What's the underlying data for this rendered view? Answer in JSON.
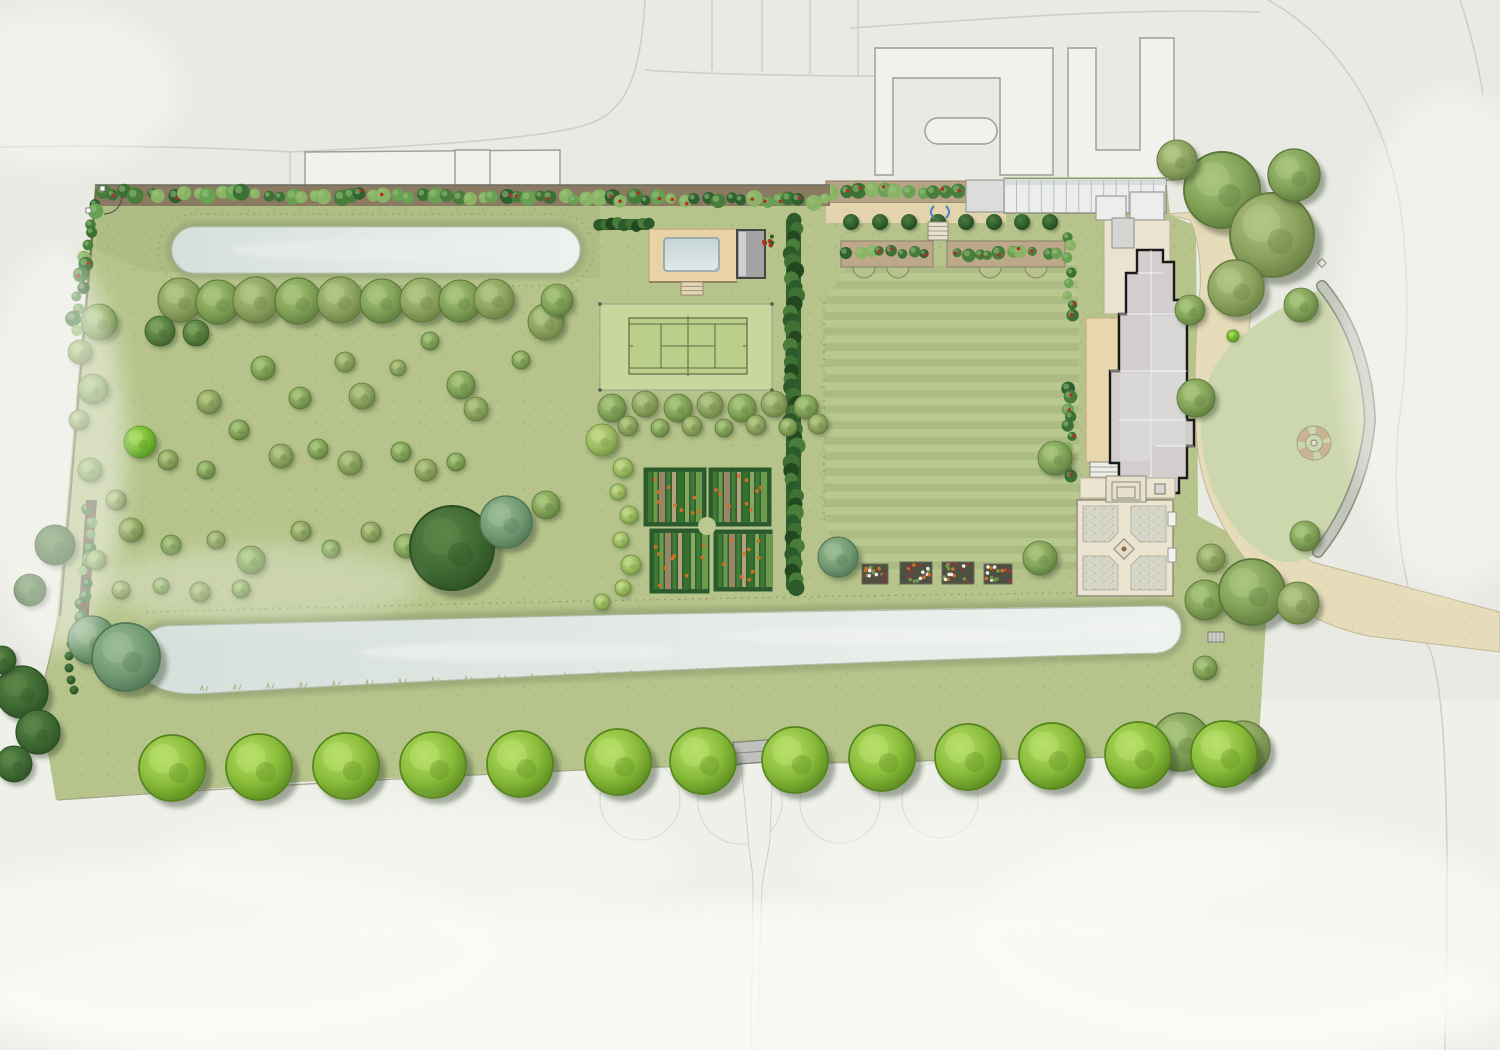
{
  "palette": {
    "bg": "#e9eae3",
    "bg_lower": "#eef0e9",
    "road_line": "#cdd0c6",
    "neighbor_stroke": "#9b9c96",
    "garden_green": "#b6c48b",
    "meadow_shade": "rgba(75,95,45,0.07)",
    "teardrop_lawn": "#cdd7ad",
    "drive_tan": "#e7dcba",
    "forecourt_cream": "#eae3d0",
    "water_light": "#e6ebe7",
    "water_mid": "#d5dfdb",
    "bank_olive": "#9aa877",
    "court_surround": "#c9d69c",
    "court_line": "#6f7e53",
    "deck_tan": "#e8d2a6",
    "pool_house_gray": "#a3a3a3",
    "house_roof": "#d1cecd",
    "house_outline": "#1a1a1a",
    "hedge_dark": "#31602e",
    "soil_brown": "#b5a385",
    "bed_border_green": "#2a5a2c",
    "orange_crop": "#d07028",
    "red_flower": "#b03028",
    "wall_gray": "#c2c6ba",
    "wall_edge": "#83877c",
    "gravel": "#d5d6c8",
    "path_cream": "#ebe4d1",
    "glyph_blue": "#4a84bb",
    "avenue_green": "#8abd3a"
  },
  "trees": {
    "tones": [
      {
        "hi": "#b8e06a",
        "body": "#8abd3a",
        "rim": "#55841c"
      },
      {
        "hi": "#c2d98a",
        "body": "#9cba62",
        "rim": "#6f8c3c"
      },
      {
        "hi": "#a9c77d",
        "body": "#82a258",
        "rim": "#5a773a"
      },
      {
        "hi": "#b4c785",
        "body": "#8ca25f",
        "rim": "#647c40"
      },
      {
        "hi": "#7fa35f",
        "body": "#567f3f",
        "rim": "#3a5c2a"
      },
      {
        "hi": "#9dbd96",
        "body": "#739c74",
        "rim": "#4e7252"
      },
      {
        "hi": "#5d8549",
        "body": "#406b34",
        "rim": "#2b4e22"
      },
      {
        "hi": "#4d7c42",
        "body": "#31602e",
        "rim": "#1e441c"
      },
      {
        "hi": "#a5dc5e",
        "body": "#74b931",
        "rim": "#4f8c1e"
      }
    ],
    "avenue": [
      [
        172,
        768
      ],
      [
        259,
        767
      ],
      [
        346,
        766
      ],
      [
        433,
        765
      ],
      [
        520,
        764
      ],
      [
        618,
        762
      ],
      [
        703,
        761
      ],
      [
        795,
        760
      ],
      [
        882,
        758
      ],
      [
        968,
        757
      ],
      [
        1052,
        756
      ],
      [
        1138,
        755
      ],
      [
        1224,
        754
      ]
    ],
    "avenue_r": 33,
    "meadow": [
      [
        180,
        300,
        22,
        3
      ],
      [
        218,
        302,
        22,
        2
      ],
      [
        256,
        300,
        23,
        3
      ],
      [
        298,
        301,
        23,
        2
      ],
      [
        340,
        300,
        23,
        3
      ],
      [
        382,
        301,
        22,
        2
      ],
      [
        422,
        300,
        22,
        3
      ],
      [
        460,
        301,
        21,
        2
      ],
      [
        494,
        299,
        20,
        3
      ],
      [
        160,
        331,
        15,
        4
      ],
      [
        196,
        333,
        13,
        4
      ],
      [
        99,
        322,
        18,
        2
      ],
      [
        80,
        352,
        12,
        3
      ],
      [
        93,
        389,
        15,
        2
      ],
      [
        79,
        420,
        10,
        3
      ],
      [
        140,
        442,
        16,
        8
      ],
      [
        90,
        470,
        12,
        2
      ],
      [
        116,
        500,
        10,
        3
      ],
      [
        96,
        560,
        10,
        2
      ],
      [
        121,
        590,
        9,
        3
      ],
      [
        161,
        586,
        8,
        2
      ],
      [
        200,
        592,
        10,
        3
      ],
      [
        241,
        589,
        9,
        2
      ],
      [
        263,
        368,
        12,
        2
      ],
      [
        345,
        362,
        10,
        3
      ],
      [
        430,
        341,
        9,
        2
      ],
      [
        398,
        368,
        8,
        3
      ],
      [
        300,
        398,
        11,
        2
      ],
      [
        209,
        402,
        12,
        3
      ],
      [
        239,
        430,
        10,
        2
      ],
      [
        362,
        396,
        13,
        3
      ],
      [
        461,
        385,
        14,
        2
      ],
      [
        476,
        409,
        12,
        3
      ],
      [
        521,
        360,
        9,
        2
      ],
      [
        546,
        322,
        18,
        3
      ],
      [
        557,
        300,
        16,
        2
      ],
      [
        168,
        460,
        10,
        3
      ],
      [
        206,
        470,
        9,
        2
      ],
      [
        281,
        456,
        12,
        3
      ],
      [
        318,
        449,
        10,
        2
      ],
      [
        350,
        463,
        12,
        3
      ],
      [
        401,
        452,
        10,
        2
      ],
      [
        426,
        470,
        11,
        3
      ],
      [
        456,
        462,
        9,
        2
      ],
      [
        131,
        530,
        12,
        3
      ],
      [
        171,
        545,
        10,
        2
      ],
      [
        216,
        540,
        9,
        3
      ],
      [
        251,
        560,
        14,
        2
      ],
      [
        301,
        531,
        10,
        3
      ],
      [
        331,
        549,
        9,
        2
      ],
      [
        371,
        532,
        10,
        3
      ],
      [
        406,
        546,
        12,
        2
      ],
      [
        441,
        520,
        10,
        3
      ],
      [
        452,
        548,
        42,
        6
      ],
      [
        506,
        522,
        26,
        5
      ],
      [
        546,
        505,
        14,
        2
      ],
      [
        92,
        640,
        24,
        5
      ],
      [
        126,
        657,
        34,
        5
      ],
      [
        22,
        692,
        26,
        6
      ],
      [
        38,
        732,
        22,
        6
      ],
      [
        14,
        764,
        18,
        6
      ],
      [
        2,
        660,
        14,
        6
      ],
      [
        55,
        545,
        20,
        6
      ],
      [
        30,
        590,
        16,
        6
      ],
      [
        602,
        440,
        16,
        1
      ],
      [
        623,
        468,
        10,
        1
      ],
      [
        618,
        492,
        8,
        1
      ],
      [
        629,
        515,
        9,
        1
      ],
      [
        621,
        540,
        8,
        1
      ],
      [
        631,
        565,
        10,
        1
      ],
      [
        623,
        588,
        8,
        1
      ],
      [
        602,
        602,
        8,
        1
      ],
      [
        612,
        408,
        14,
        2
      ],
      [
        645,
        404,
        13,
        3
      ],
      [
        678,
        408,
        14,
        2
      ],
      [
        710,
        405,
        13,
        3
      ],
      [
        742,
        408,
        14,
        2
      ],
      [
        774,
        404,
        13,
        3
      ],
      [
        806,
        407,
        12,
        2
      ],
      [
        628,
        426,
        10,
        3
      ],
      [
        660,
        428,
        9,
        2
      ],
      [
        692,
        426,
        10,
        3
      ],
      [
        724,
        428,
        9,
        2
      ],
      [
        756,
        425,
        10,
        3
      ],
      [
        788,
        427,
        9,
        2
      ],
      [
        818,
        424,
        10,
        3
      ],
      [
        838,
        557,
        20,
        5
      ],
      [
        1040,
        558,
        17,
        2
      ],
      [
        1055,
        458,
        17,
        2
      ],
      [
        1205,
        600,
        20,
        2
      ],
      [
        1252,
        592,
        33,
        2
      ],
      [
        1298,
        603,
        21,
        3
      ],
      [
        1211,
        558,
        14,
        3
      ],
      [
        1205,
        668,
        12,
        2
      ],
      [
        1181,
        742,
        29,
        2
      ],
      [
        1243,
        748,
        27,
        3
      ],
      [
        1190,
        310,
        15,
        2
      ],
      [
        1196,
        398,
        19,
        2
      ],
      [
        1228,
        300,
        9,
        8
      ],
      [
        1233,
        336,
        6,
        8
      ],
      [
        1305,
        536,
        15,
        2
      ],
      [
        1222,
        190,
        38,
        2
      ],
      [
        1272,
        235,
        42,
        3
      ],
      [
        1294,
        175,
        26,
        2
      ],
      [
        1236,
        288,
        28,
        3
      ],
      [
        1301,
        305,
        17,
        2
      ],
      [
        1177,
        160,
        20,
        3
      ]
    ]
  },
  "map": {
    "canvas": [
      1500,
      1050
    ],
    "roads": [
      "M0,147 C150,144 260,150 290,152 L290,186",
      "M290,152 C420,146 520,140 575,128 C620,118 640,90 645,0",
      "M712,0 L712,70",
      "M762,0 L762,72",
      "M810,0 L810,74",
      "M858,0 L858,76",
      "M645,70 C700,74 800,76 875,76",
      "M850,28 C1000,18 1120,8 1260,12",
      "M1268,0 C1340,40 1390,120 1402,220 C1410,290 1408,360 1398,430",
      "M1398,430 C1392,520 1402,590 1430,650 C1446,692 1450,820 1445,1050",
      "M1460,0 C1470,30 1478,62 1483,95"
    ],
    "neighbors": [
      {
        "d": "M875,48 L1053,48 L1053,175 L1000,175 L1000,78 L893,78 L893,175 L875,175 Z"
      },
      {
        "d": "M938,118 h46 a13,13 0 0 1 0,26 h-46 a13,13 0 0 1 0,-26 Z"
      },
      {
        "d": "M1068,48 L1096,48 L1096,150 L1140,150 L1140,38 L1174,38 L1174,180 L1068,180 Z"
      },
      {
        "d": "M305,152 L560,150 L560,186 L305,186 Z"
      },
      {
        "d": "M455,150 L490,150 L490,186 L455,186 Z"
      }
    ],
    "faint_circles": [
      [
        640,
        800,
        40
      ],
      [
        740,
        802,
        42
      ],
      [
        840,
        803,
        40
      ],
      [
        940,
        800,
        38
      ]
    ],
    "garden": {
      "d": "M95,184 L828,196 L828,181 L1004,181 L1004,177 L1166,177 L1170,215 L1196,226 L1198,516 L1258,548 L1308,562 L1282,588 L1266,622 L1258,756 L1100,758 L660,767 L300,782 L56,800 L40,706 L57,616 Z",
      "top_shade": "M96,186 L600,196 L600,278 L150,272 L96,250 Z"
    },
    "teardrop": "M1324,288 C1292,300 1246,326 1222,356 C1200,384 1196,428 1206,468 C1216,508 1240,540 1266,556 C1286,566 1306,562 1318,552 C1344,520 1366,472 1370,420 C1368,372 1350,322 1324,288 Z",
    "drive": "M1166,214 L1254,208 C1262,252 1252,300 1246,352 C1240,404 1246,470 1270,515 C1282,536 1298,552 1312,562 L1500,612 L1500,652 L1368,636 C1322,626 1288,606 1262,578 C1226,540 1204,498 1198,452 C1192,400 1196,330 1200,290 C1202,258 1196,232 1190,220 Z",
    "forecourt": [
      1104,
      220,
      66,
      94
    ],
    "wall": "M1322,286 C1352,322 1368,370 1370,420 C1366,472 1344,520 1318,552",
    "circle_feature": [
      1314,
      443
    ],
    "marker": [
      1322,
      263
    ],
    "lawn": {
      "d": "M846,268 L1078,262 L1080,570 L846,574 L824,520 L824,302 Z",
      "dash": [
        824,
        302,
        824,
        520
      ]
    },
    "top_pond": {
      "rect": [
        172,
        227,
        408,
        46,
        23
      ],
      "bank": [
        166,
        221,
        420,
        58,
        29
      ],
      "dash": [
        158,
        214,
        436,
        72,
        36
      ]
    },
    "bottom_pond": {
      "water": "M166,626 C480,617 860,609 1160,606 C1173,606 1181,615 1181,628 C1181,642 1172,651 1158,653 C860,661 500,676 210,693 C186,695 166,693 152,684 C140,676 134,662 138,648 C141,637 151,629 166,626 Z",
      "dots": "M146,612 C500,602 900,594 1172,592"
    },
    "tennis": {
      "surround": [
        600,
        304,
        172,
        86
      ],
      "court": [
        629,
        318,
        118,
        56
      ]
    },
    "pool": {
      "deck": [
        649,
        229,
        88,
        53
      ],
      "water": [
        664,
        238,
        55,
        33
      ],
      "house": [
        737,
        230,
        28,
        48
      ],
      "steps": [
        681,
        282,
        22,
        13
      ],
      "flowers": [
        768,
        240
      ],
      "hedge_left": [
        596,
        219,
        56,
        11
      ]
    },
    "long_hedge": [
      786,
      216,
      15,
      376
    ],
    "kitchen": {
      "beds": [
        [
          645,
          469,
          60,
          56
        ],
        [
          710,
          469,
          60,
          56
        ],
        [
          651,
          530,
          57,
          62
        ],
        [
          715,
          531,
          56,
          59
        ]
      ],
      "circle": [
        707,
        526,
        9
      ],
      "stripe_colors": [
        "#3f7a35",
        "#6b9b4b",
        "#9b8568",
        "#447c39",
        "#b3a07c",
        "#35702f",
        "#86a861"
      ]
    },
    "espalier": {
      "soil": [
        826,
        181,
        178,
        22
      ],
      "path": [
        826,
        203,
        180,
        20
      ],
      "row": [
        834,
        192,
        996,
        192,
        14
      ]
    },
    "greenhouse": {
      "r": [
        1004,
        179,
        162,
        34
      ],
      "ribs": 13
    },
    "shed": [
      966,
      180,
      38,
      32
    ],
    "pleached": {
      "y": 222,
      "xs": [
        851,
        880,
        909,
        938,
        966,
        994,
        1022,
        1050
      ],
      "r": 8
    },
    "terrace_steps": [
      928,
      222,
      20,
      18
    ],
    "glyph": [
      940,
      212
    ],
    "borders": [
      {
        "r": [
          841,
          241,
          92,
          26
        ],
        "scallops": [
          864,
          898
        ]
      },
      {
        "r": [
          947,
          241,
          118,
          26
        ],
        "scallops": [
          990,
          1036
        ]
      }
    ],
    "cutting": [
      [
        862,
        564,
        26,
        20
      ],
      [
        900,
        562,
        32,
        22
      ],
      [
        942,
        562,
        32,
        22
      ],
      [
        984,
        564,
        28,
        20
      ]
    ],
    "house": {
      "outline": "M1137,250 L1163,250 L1163,262 L1174,262 L1174,300 L1181,300 L1181,314 L1187,314 L1187,420 L1194,420 L1194,446 L1187,446 L1187,478 L1179,478 L1179,493 L1156,493 L1156,479 L1119,479 L1119,463 L1110,463 L1110,371 L1119,371 L1119,314 L1126,314 L1126,273 L1137,273 Z",
      "panels": [
        [
          1152,
          316,
          33,
          130
        ],
        [
          1120,
          373,
          30,
          88
        ]
      ],
      "ridges": [
        "M1137,273 L1163,273",
        "M1151,250 L1151,479",
        "M1110,371 L1187,371",
        "M1119,314 L1181,314",
        "M1156,446 L1194,446",
        "M1119,420 L1187,420"
      ],
      "terrace": [
        1086,
        318,
        32,
        144
      ],
      "steps": [
        1090,
        462,
        28,
        30
      ],
      "north": [
        [
          1096,
          196,
          30,
          24
        ],
        [
          1130,
          192,
          34,
          28
        ],
        [
          1112,
          218,
          22,
          30
        ]
      ]
    },
    "west_border": [
      [
        1070,
        236,
        1070,
        316
      ],
      [
        1070,
        388,
        1070,
        478
      ]
    ],
    "walled": {
      "base": [
        1077,
        500,
        96,
        96
      ],
      "quads": [
        "M1083,506 L1118,506 L1118,533 L1109,542 L1083,542 Z",
        "M1131,506 L1166,506 L1166,542 L1140,542 L1131,533 Z",
        "M1083,556 L1109,556 L1118,565 L1118,590 L1083,590 Z",
        "M1140,556 L1166,556 L1166,590 L1131,590 L1131,565 Z"
      ],
      "diamond": [
        1124,
        549,
        10
      ],
      "steps": [
        [
          1106,
          476,
          40,
          26
        ],
        [
          1112,
          482,
          28,
          18
        ],
        [
          1117,
          487,
          18,
          11
        ]
      ],
      "piers": [
        [
          1168,
          512,
          8,
          14
        ],
        [
          1168,
          548,
          8,
          14
        ]
      ],
      "south_terrace": [
        1080,
        478,
        95,
        20
      ],
      "pillars": [
        [
          1128,
          484,
          10,
          10
        ],
        [
          1155,
          484,
          10,
          10
        ]
      ]
    },
    "top_hedge": {
      "band": [
        95,
        185,
        735,
        21
      ],
      "x0": 102,
      "y0": 193,
      "x1": 824,
      "y1": 201,
      "n": 62
    },
    "left_boundary": {
      "line": [
        96,
        190,
        60,
        616
      ],
      "faint": [
        60,
        616,
        22,
        770
      ],
      "shrubs": [
        94,
        202,
        74,
        330,
        13
      ],
      "bed": "M86,500 L97,500 L88,625 L78,623 Z",
      "chain": [
        [
          74,
          632
        ],
        [
          71,
          644
        ],
        [
          69,
          656
        ],
        [
          69,
          668
        ],
        [
          71,
          680
        ],
        [
          74,
          690
        ]
      ]
    },
    "gate": {
      "x": 752,
      "y": 752,
      "w": 36,
      "h": 22,
      "rot": -4
    },
    "gate_path": "M741,763 L773,762 L770,836 C769,856 764,866 762,886 L757,1050 L751,1050 L753,886 C753,866 749,856 748,836 Z",
    "verge": "M58,800 C300,783 520,772 660,767 C900,760 1100,757 1258,756",
    "bench": [
      1208,
      632,
      16,
      10
    ],
    "mist": [
      [
        750,
        1000,
        760,
        95,
        0.8
      ],
      [
        200,
        950,
        300,
        90,
        0.6
      ],
      [
        1250,
        935,
        280,
        110,
        0.6
      ],
      [
        420,
        865,
        260,
        55,
        0.45
      ],
      [
        1050,
        865,
        240,
        55,
        0.45
      ],
      [
        55,
        450,
        70,
        200,
        0.5
      ],
      [
        1452,
        340,
        110,
        250,
        0.45
      ],
      [
        60,
        90,
        120,
        80,
        0.45
      ],
      [
        260,
        585,
        160,
        40,
        0.3
      ]
    ]
  }
}
